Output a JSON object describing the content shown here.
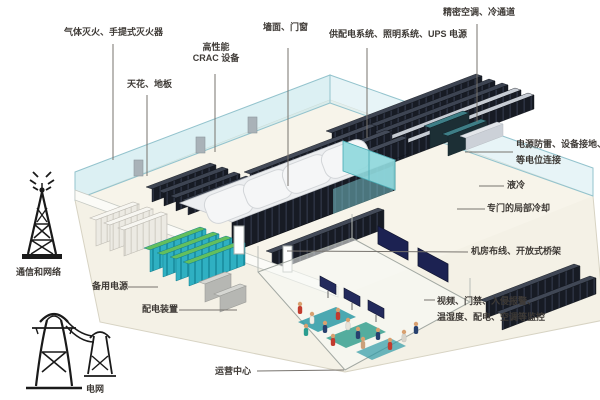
{
  "labels": {
    "fire_suppression": "气体灭火、手提式灭火器",
    "ceiling_floor": "天花、地板",
    "crac_line1": "高性能",
    "crac_line2": "CRAC 设备",
    "walls_doors": "墙面、门窗",
    "power_systems": "供配电系统、照明系统、UPS 电源",
    "precision_ac": "精密空调、冷通道",
    "grounding_line1": "电源防雷、设备接地、",
    "grounding_line2": "等电位连接",
    "liquid_cooling": "液冷",
    "local_cooling": "专门的局部冷却",
    "cabling": "机房布线、开放式桥架",
    "monitoring_line1": "视频、门禁、入侵报警、",
    "monitoring_line2": "温湿度、配电、空调等监控",
    "ops_center": "运营中心",
    "comm_network": "通信和网络",
    "backup_power": "备用电源",
    "power_distribution": "配电装置",
    "power_grid": "电网"
  },
  "icons": {
    "comm_tower": "comm-tower-icon",
    "power_pylons": "power-pylons-icon"
  },
  "colors": {
    "glass_wall": "#bfe3ea",
    "floor": "#f4f1e6",
    "rack_dark": "#171b24",
    "pod_top": "#eceef0",
    "glass_teal": "#8fd8dc",
    "battery_teal": "#2fb0c2",
    "battery_top_green": "#63bf5e",
    "screen_navy": "#1c2252",
    "label_text": "#3e3a36"
  }
}
